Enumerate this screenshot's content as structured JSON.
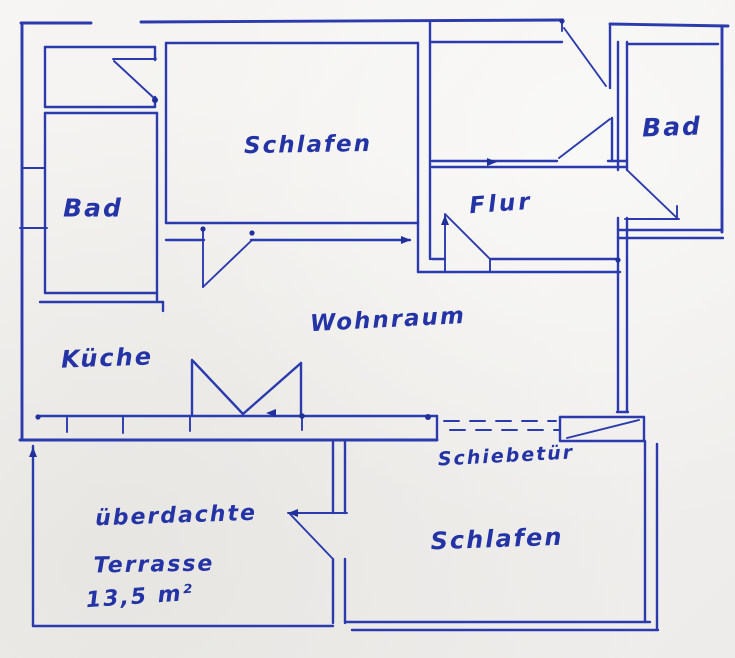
{
  "drawing": {
    "type": "hand-drawn floor plan",
    "palette": {
      "ink": "#2b3aad",
      "text": "#2433a5",
      "paper": "#f3f2ef"
    }
  },
  "labels": {
    "schlafen_top": "Schlafen",
    "bad_left": "Bad",
    "bad_right": "Bad",
    "flur": "Flur",
    "wohnraum": "Wohnraum",
    "kueche": "Küche",
    "schiebetuer": "Schiebetür",
    "schlafen_bottom": "Schlafen",
    "terrasse_line1": "überdachte",
    "terrasse_line2": "Terrasse",
    "terrasse_area": "13,5 m²"
  }
}
